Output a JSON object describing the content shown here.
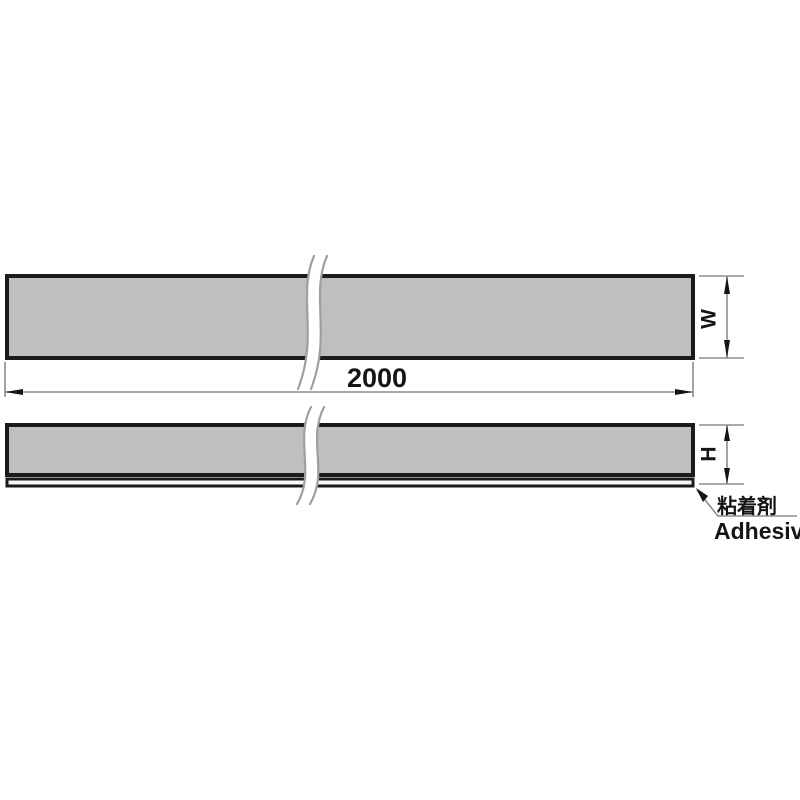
{
  "diagram": {
    "labels": {
      "length": "2000",
      "width": "W",
      "height": "H",
      "adhesive_ja": "粘着剤",
      "adhesive_en": "Adhesive"
    },
    "colors": {
      "background": "#ffffff",
      "strip_fill": "#bfbfbf",
      "adhesive_fill": "#fafafa",
      "outline": "#1b1b1b",
      "dimension_line": "#8d8d8d",
      "break_line": "#9f9f9f",
      "ink": "#151515"
    }
  }
}
